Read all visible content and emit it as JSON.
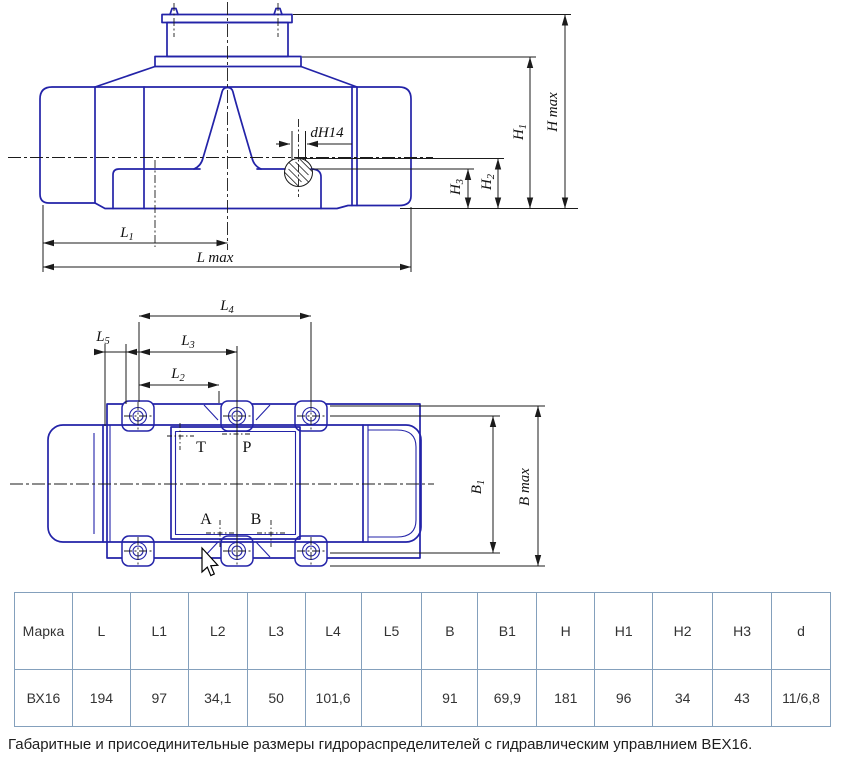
{
  "drawing_front": {
    "dim_labels": {
      "d_hole": "dH14",
      "l1": {
        "main": "L",
        "sub": "1"
      },
      "l_max": "L max",
      "h1": {
        "main": "H",
        "sub": "1"
      },
      "h2": {
        "main": "H",
        "sub": "2"
      },
      "h3": {
        "main": "H",
        "sub": "3"
      },
      "h_max": "H max"
    }
  },
  "drawing_top": {
    "dim_labels": {
      "l2": {
        "main": "L",
        "sub": "2"
      },
      "l3": {
        "main": "L",
        "sub": "3"
      },
      "l4": {
        "main": "L",
        "sub": "4"
      },
      "l5": {
        "main": "L",
        "sub": "5"
      },
      "b1": {
        "main": "B",
        "sub": "1"
      },
      "b_max": "B max"
    },
    "ports": {
      "t": "T",
      "p": "P",
      "a": "A",
      "b": "B"
    }
  },
  "table": {
    "headers": [
      "Марка",
      "L",
      "L1",
      "L2",
      "L3",
      "L4",
      "L5",
      "B",
      "B1",
      "H",
      "H1",
      "H2",
      "H3",
      "d"
    ],
    "rows": [
      [
        "ВХ16",
        "194",
        "97",
        "34,1",
        "50",
        "101,6",
        "",
        "91",
        "69,9",
        "181",
        "96",
        "34",
        "43",
        "11/6,8"
      ]
    ]
  },
  "caption": "Габаритные и присоединительные размеры гидрораспределителей с гидравлическим управлнием ВЕХ16.",
  "colors": {
    "drawing_blue": "#2323a8",
    "dimension_black": "#1b1b1b",
    "table_border": "#84a0bc",
    "text": "#333333"
  }
}
